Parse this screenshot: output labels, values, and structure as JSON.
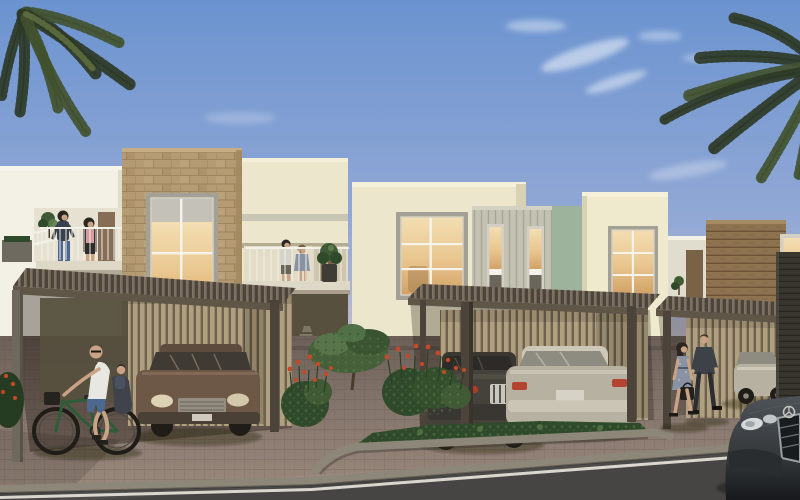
{
  "scene": {
    "type": "architectural-rendering",
    "description": "Photorealistic render of a modern townhouse community: cream and stone-clad two-storey homes with timber pergola carports, five cars, a man cycling with a child seat, a couple walking, residents on balconies, palm trees, red-flowering shrubs and a paved driveway beside an asphalt road under a blue evening sky.",
    "objects": [
      "sky",
      "clouds",
      "palm-tree-left",
      "palm-fronds-right",
      "townhouse-left",
      "stone-feature-tower",
      "balcony",
      "stair-railing",
      "walkway-balcony",
      "townhouse-center",
      "slatted-facade",
      "lit-windows",
      "wood-clad-house-right",
      "pergola-carport-left",
      "pergola-carport-center",
      "pergola-carport-right",
      "slat-privacy-screens",
      "brown-car",
      "dark-grey-car",
      "silver-sedan",
      "silver-car-side",
      "mercedes-front",
      "bicycle",
      "cyclist-with-child",
      "balcony-women",
      "walkway-couple",
      "walking-couple",
      "flower-bushes",
      "courtyard-tree",
      "ground-cover-bed",
      "paver-driveway",
      "asphalt-road",
      "road-edge-line",
      "dark-clad-column"
    ],
    "people_count": 8,
    "vehicle_count": 6
  },
  "palette": {
    "sky_top": "#6b93d0",
    "sky_mid": "#93a9d5",
    "sky_low": "#c6c0c9",
    "sky_horizon": "#ddd0c4",
    "cloud": "#ffffff",
    "palm_dark": "#2e3a27",
    "palm_mid": "#41512f",
    "palm_light": "#5c6c3e",
    "wall_white": "#f3f1e6",
    "wall_white_shade": "#e0dcce",
    "wall_cream": "#ece7cc",
    "wall_cream2": "#efeace",
    "wall_cream_shade": "#d8d1b4",
    "wall_sage": "#c4c2b2",
    "sage_slat": "#a9a794",
    "sage_side": "#9eb39c",
    "stone_tan": "#b49b74",
    "stone_mortar": "#93794f",
    "stone_hi": "#c7ad83",
    "stone_lo": "#a2875e",
    "wood_plank": "#8e7350",
    "wood_plank_dark": "#6d5336",
    "wood_door": "#7a6247",
    "dark_clad": "#39352f",
    "dark_clad_line": "#282521",
    "pergola_slat_a": "#7d7264",
    "pergola_slat_b": "#4d453a",
    "pergola_beam": "#5f5647",
    "post_grey": "#6f685d",
    "post_dark": "#4c443b",
    "screen_slat": "#b1a07f",
    "screen_gap": "#6d6150",
    "window_frame": "#a3a095",
    "window_frame_light": "#d4cfc2",
    "glass_warm_hi": "#f3deb2",
    "glass_warm_mid": "#e9c68e",
    "glass_warm_lo": "#d2a267",
    "glass_dark": "#56534b",
    "glass_grey": "#c4c1b8",
    "glass_car": "#8e8b80",
    "mullion": "#f5f3eb",
    "railing_white": "#f1f1ea",
    "slab_light": "#ded9c7",
    "recess_dark": "#57503f",
    "car_brown": "#6d5847",
    "car_brown_dark": "#4b4035",
    "car_dark": "#45423c",
    "car_dark_deep": "#2d2b27",
    "car_silver": "#b7b1a2",
    "car_silver_hi": "#cdc8b8",
    "car_silver_dark": "#8e897b",
    "tyre": "#201d19",
    "chrome": "#c9c6bd",
    "red_light": "#b23a24",
    "merc_body": "#33373a",
    "merc_body_hi": "#4e5358",
    "merc_deep": "#17191b",
    "pavement_hi": "#9c8a7d",
    "pavement": "#83746b",
    "pavement_dark": "#6b5f57",
    "paver_line": "#564c44",
    "curb_grey": "#8d8779",
    "road": "#464543",
    "road_line": "#e6e3da",
    "leaf_dark": "#2f4a2b",
    "leaf_mid": "#3f5a34",
    "leaf_light": "#5d7d4c",
    "flower_red": "#c24a27",
    "trunk": "#4a3b2c",
    "skin": "#c9a384",
    "hair": "#2b2622",
    "shirt_white": "#e9e7e1",
    "denim": "#4d6890",
    "bike_green": "#2d5c37",
    "navy": "#39404d",
    "pink": "#d69aa0",
    "dress_blue": "#8a93a5",
    "suit_dark": "#3d4148",
    "trouser_dark": "#2c2e33",
    "bag_dark": "#23211e",
    "shadow": "rgba(25,18,12,0.35)"
  }
}
